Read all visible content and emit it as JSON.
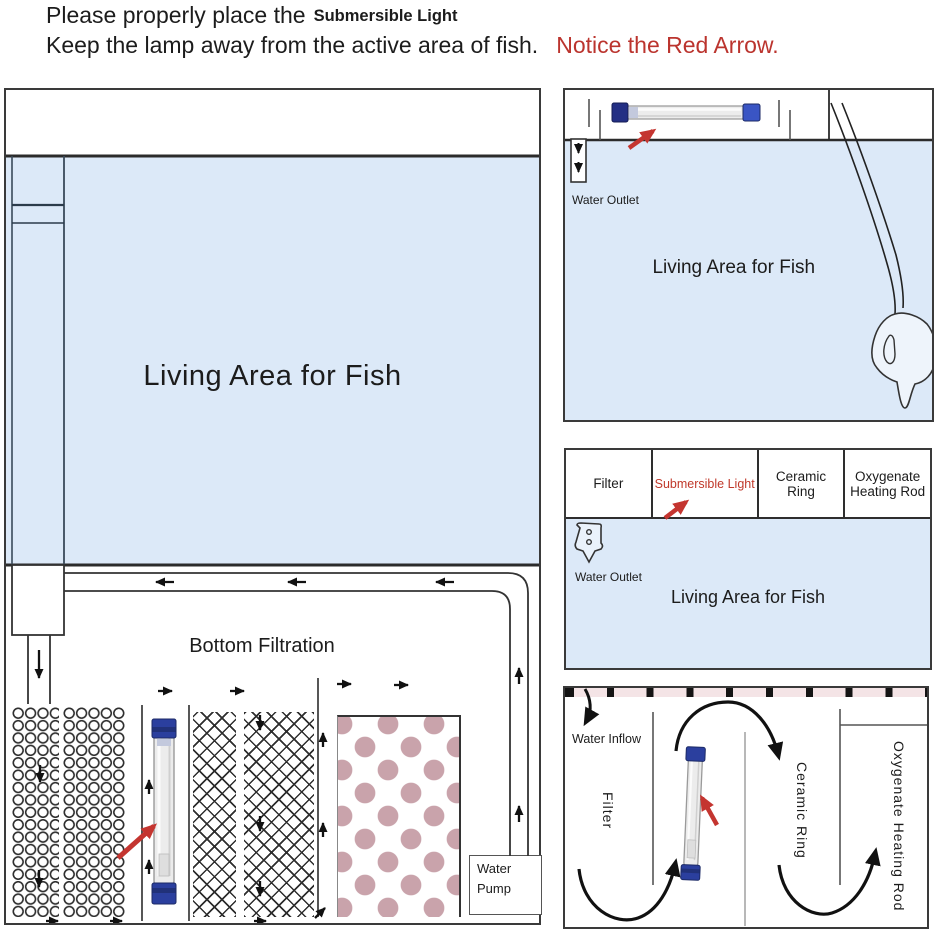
{
  "header": {
    "line1": "Please properly place the",
    "highlight": "Submersible Light",
    "line2": "Keep the lamp away from the active area of fish.",
    "notice": "Notice the Red Arrow."
  },
  "left_panel": {
    "living_area_label": "Living Area for Fish",
    "section_label": "Bottom Filtration",
    "water_pump_label": "Water Pump"
  },
  "top_right_panel": {
    "water_outlet_label": "Water Outlet",
    "living_area_label": "Living Area for Fish",
    "water_pump_label": "Water Pump"
  },
  "middle_right_panel": {
    "columns": [
      {
        "label": "Filter",
        "color": "#222222"
      },
      {
        "label": "Submersible Light",
        "color": "#c0392b"
      },
      {
        "label": "Ceramic Ring",
        "color": "#222222"
      },
      {
        "label": "Oxygenate Heating Rod",
        "color": "#222222"
      }
    ],
    "water_outlet_label": "Water Outlet",
    "living_area_label": "Living Area for Fish"
  },
  "bottom_right_panel": {
    "water_inflow_label": "Water Inflow",
    "filter_label": "Filter",
    "ceramic_ring_label": "Ceramic Ring",
    "oxygenate_label": "Oxygenate Heating Rod"
  },
  "colors": {
    "water_fill": "#dce9f8",
    "notice_red": "#bb342e",
    "arrow_red": "#c43530",
    "ceramic_dot": "#c9a3ab",
    "grate_strip": "#f4e4e6",
    "light_cap_blue": "#2b3f9e"
  }
}
